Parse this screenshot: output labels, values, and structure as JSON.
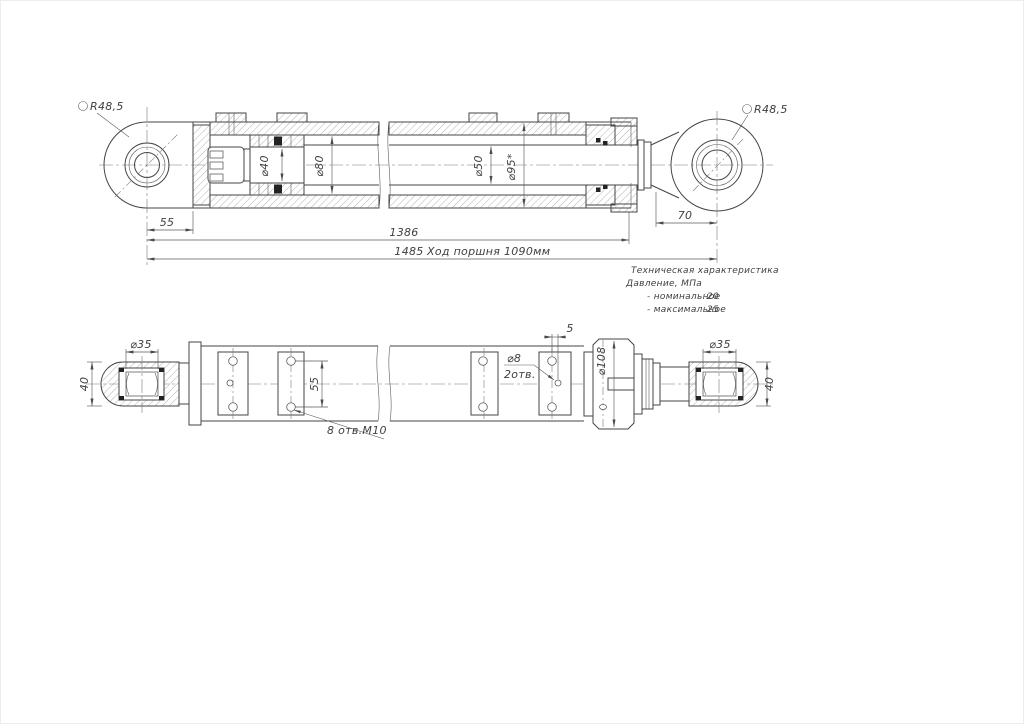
{
  "colors": {
    "line": "#454545",
    "text": "#3f3f3f",
    "seal": "#232323",
    "background": "#ffffff"
  },
  "top_view": {
    "eye_radius_left": "R48,5",
    "eye_radius_right": "R48,5",
    "rod_journal_dia": "⌀40",
    "piston_dia": "⌀80",
    "rod_dia": "⌀50",
    "barrel_dia": "⌀95*",
    "dim_eye_to_body": "55",
    "dim_body_length": "1386",
    "dim_overall": "1485",
    "stroke_note": "Ход поршня 1090мм",
    "dim_rod_end": "70"
  },
  "specs": {
    "title": "Техническая характеристика",
    "pressure": "Давление, МПа",
    "nominal_label": "- номинальное",
    "nominal_value": "20",
    "maximum_label": "- максимальное",
    "maximum_value": "25"
  },
  "bottom_view": {
    "eye_bore_left": "⌀35",
    "eye_width_left": "40",
    "hole_pitch": "55",
    "mount_holes_note": "8 отв.М10",
    "port_offset": "5",
    "port_dia": "⌀8",
    "port_qty": "2отв.",
    "flange_dia": "⌀108",
    "eye_bore_right": "⌀35",
    "eye_width_right": "40"
  }
}
